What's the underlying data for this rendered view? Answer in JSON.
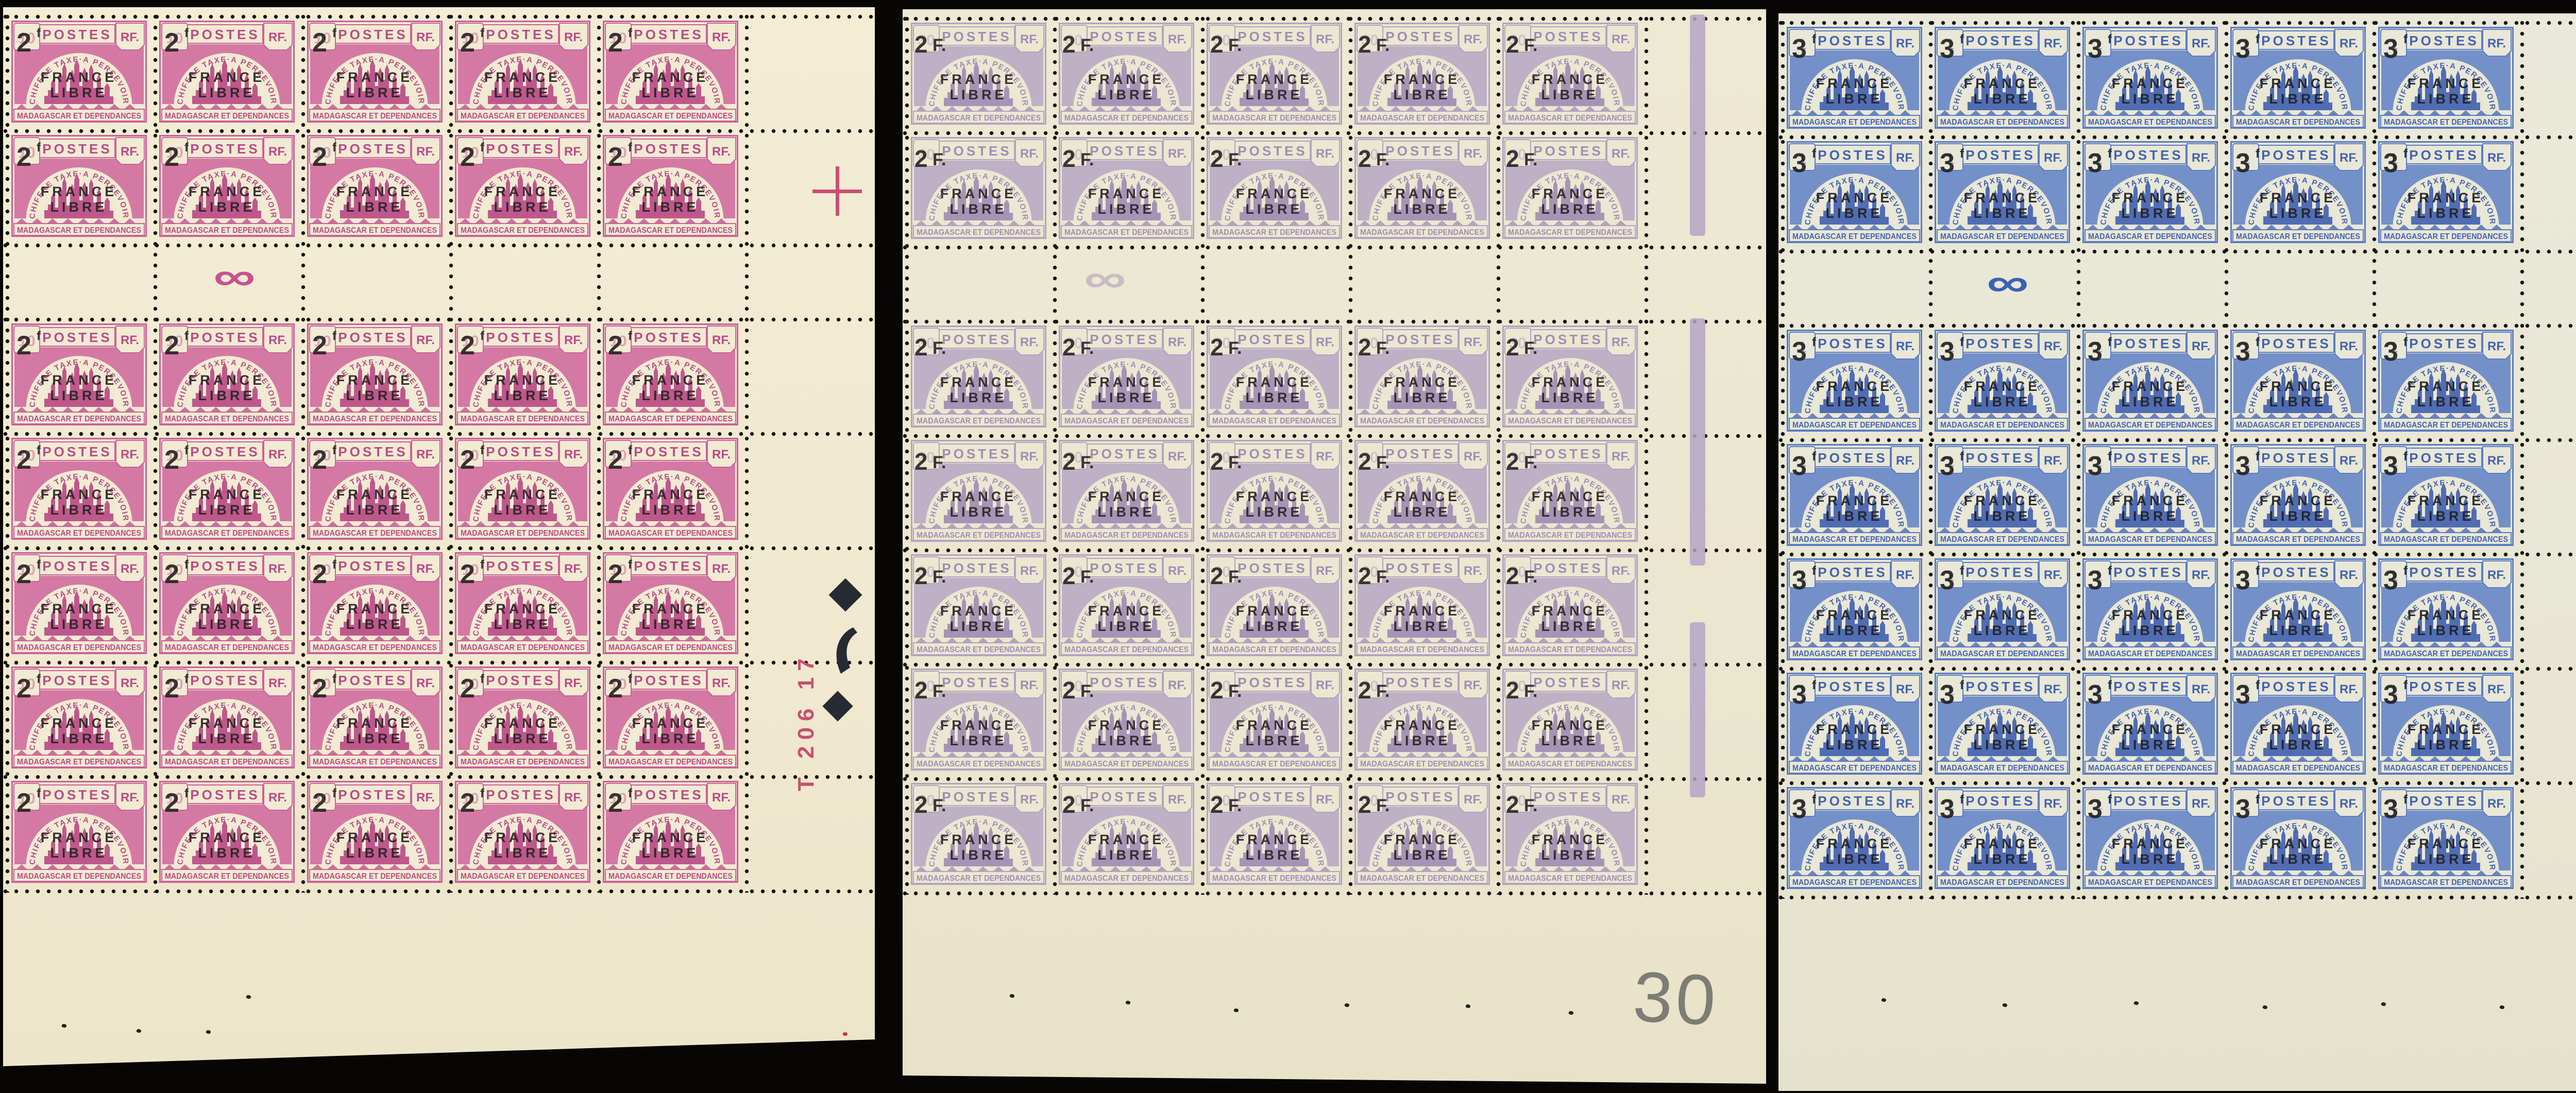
{
  "scene": {
    "background_color": "#070605",
    "description": "Three margin blocks of 35 overprinted postage-due stamps on black background"
  },
  "stamp_face": {
    "postes_label": "POSTES",
    "rf_label": "RF.",
    "arc_text": "CHIFFRE TAXE·A PERCEVOIR",
    "bottom_text": "MADAGASCAR ET DEPENDANCES"
  },
  "sheets": [
    {
      "name": "rose-sheet",
      "paper": "#f1ebd3",
      "ink": "#cd5f9a",
      "ink_deep": "#ba4b86",
      "base_value_hint": "10",
      "overprint": {
        "value_main": "2",
        "value_sup": "f",
        "style": "superscript",
        "line1": "FRANCE",
        "line2": "LIBRE",
        "color": "#2a2423"
      },
      "grid": {
        "columns": 5,
        "rows_above_gutter": 2,
        "rows_below_gutter": 5,
        "total_stamps": 35
      },
      "gutter_mark": "∞",
      "margin": {
        "plate_number_text": "T 206 17",
        "plate_number_color": "#c94f72",
        "registration_cross": true,
        "corner_marks": "diamond, crescent, diamond"
      }
    },
    {
      "name": "lilac-sheet",
      "paper": "#ece7d1",
      "ink": "#b3a3c2",
      "ink_deep": "#9f8db3",
      "base_value_hint": "30",
      "overprint": {
        "value_main": "2",
        "value_sup": "F.",
        "style": "inline",
        "line1": "FRANCE",
        "line2": "LIBRE",
        "color": "#2a2625"
      },
      "grid": {
        "columns": 5,
        "rows_above_gutter": 2,
        "rows_below_gutter": 5,
        "total_stamps": 35
      },
      "gutter_mark": "∞",
      "margin": {
        "color_bar": "#b5a4c7",
        "pencil_note": "30"
      }
    },
    {
      "name": "blue-sheet",
      "paper": "#e9e7d6",
      "ink": "#5a7cc4",
      "ink_deep": "#4263b1",
      "base_value_hint": "1",
      "overprint": {
        "value_main": "3",
        "value_sup": "f",
        "style": "superscript",
        "line1": "FRANCE",
        "line2": "LIBRE",
        "color": "#232122"
      },
      "grid": {
        "columns": 5,
        "rows_above_gutter": 2,
        "rows_below_gutter": 5,
        "total_stamps": 35
      },
      "gutter_mark": "∞",
      "margin": {
        "color_bar": "#2d54a8"
      }
    }
  ]
}
